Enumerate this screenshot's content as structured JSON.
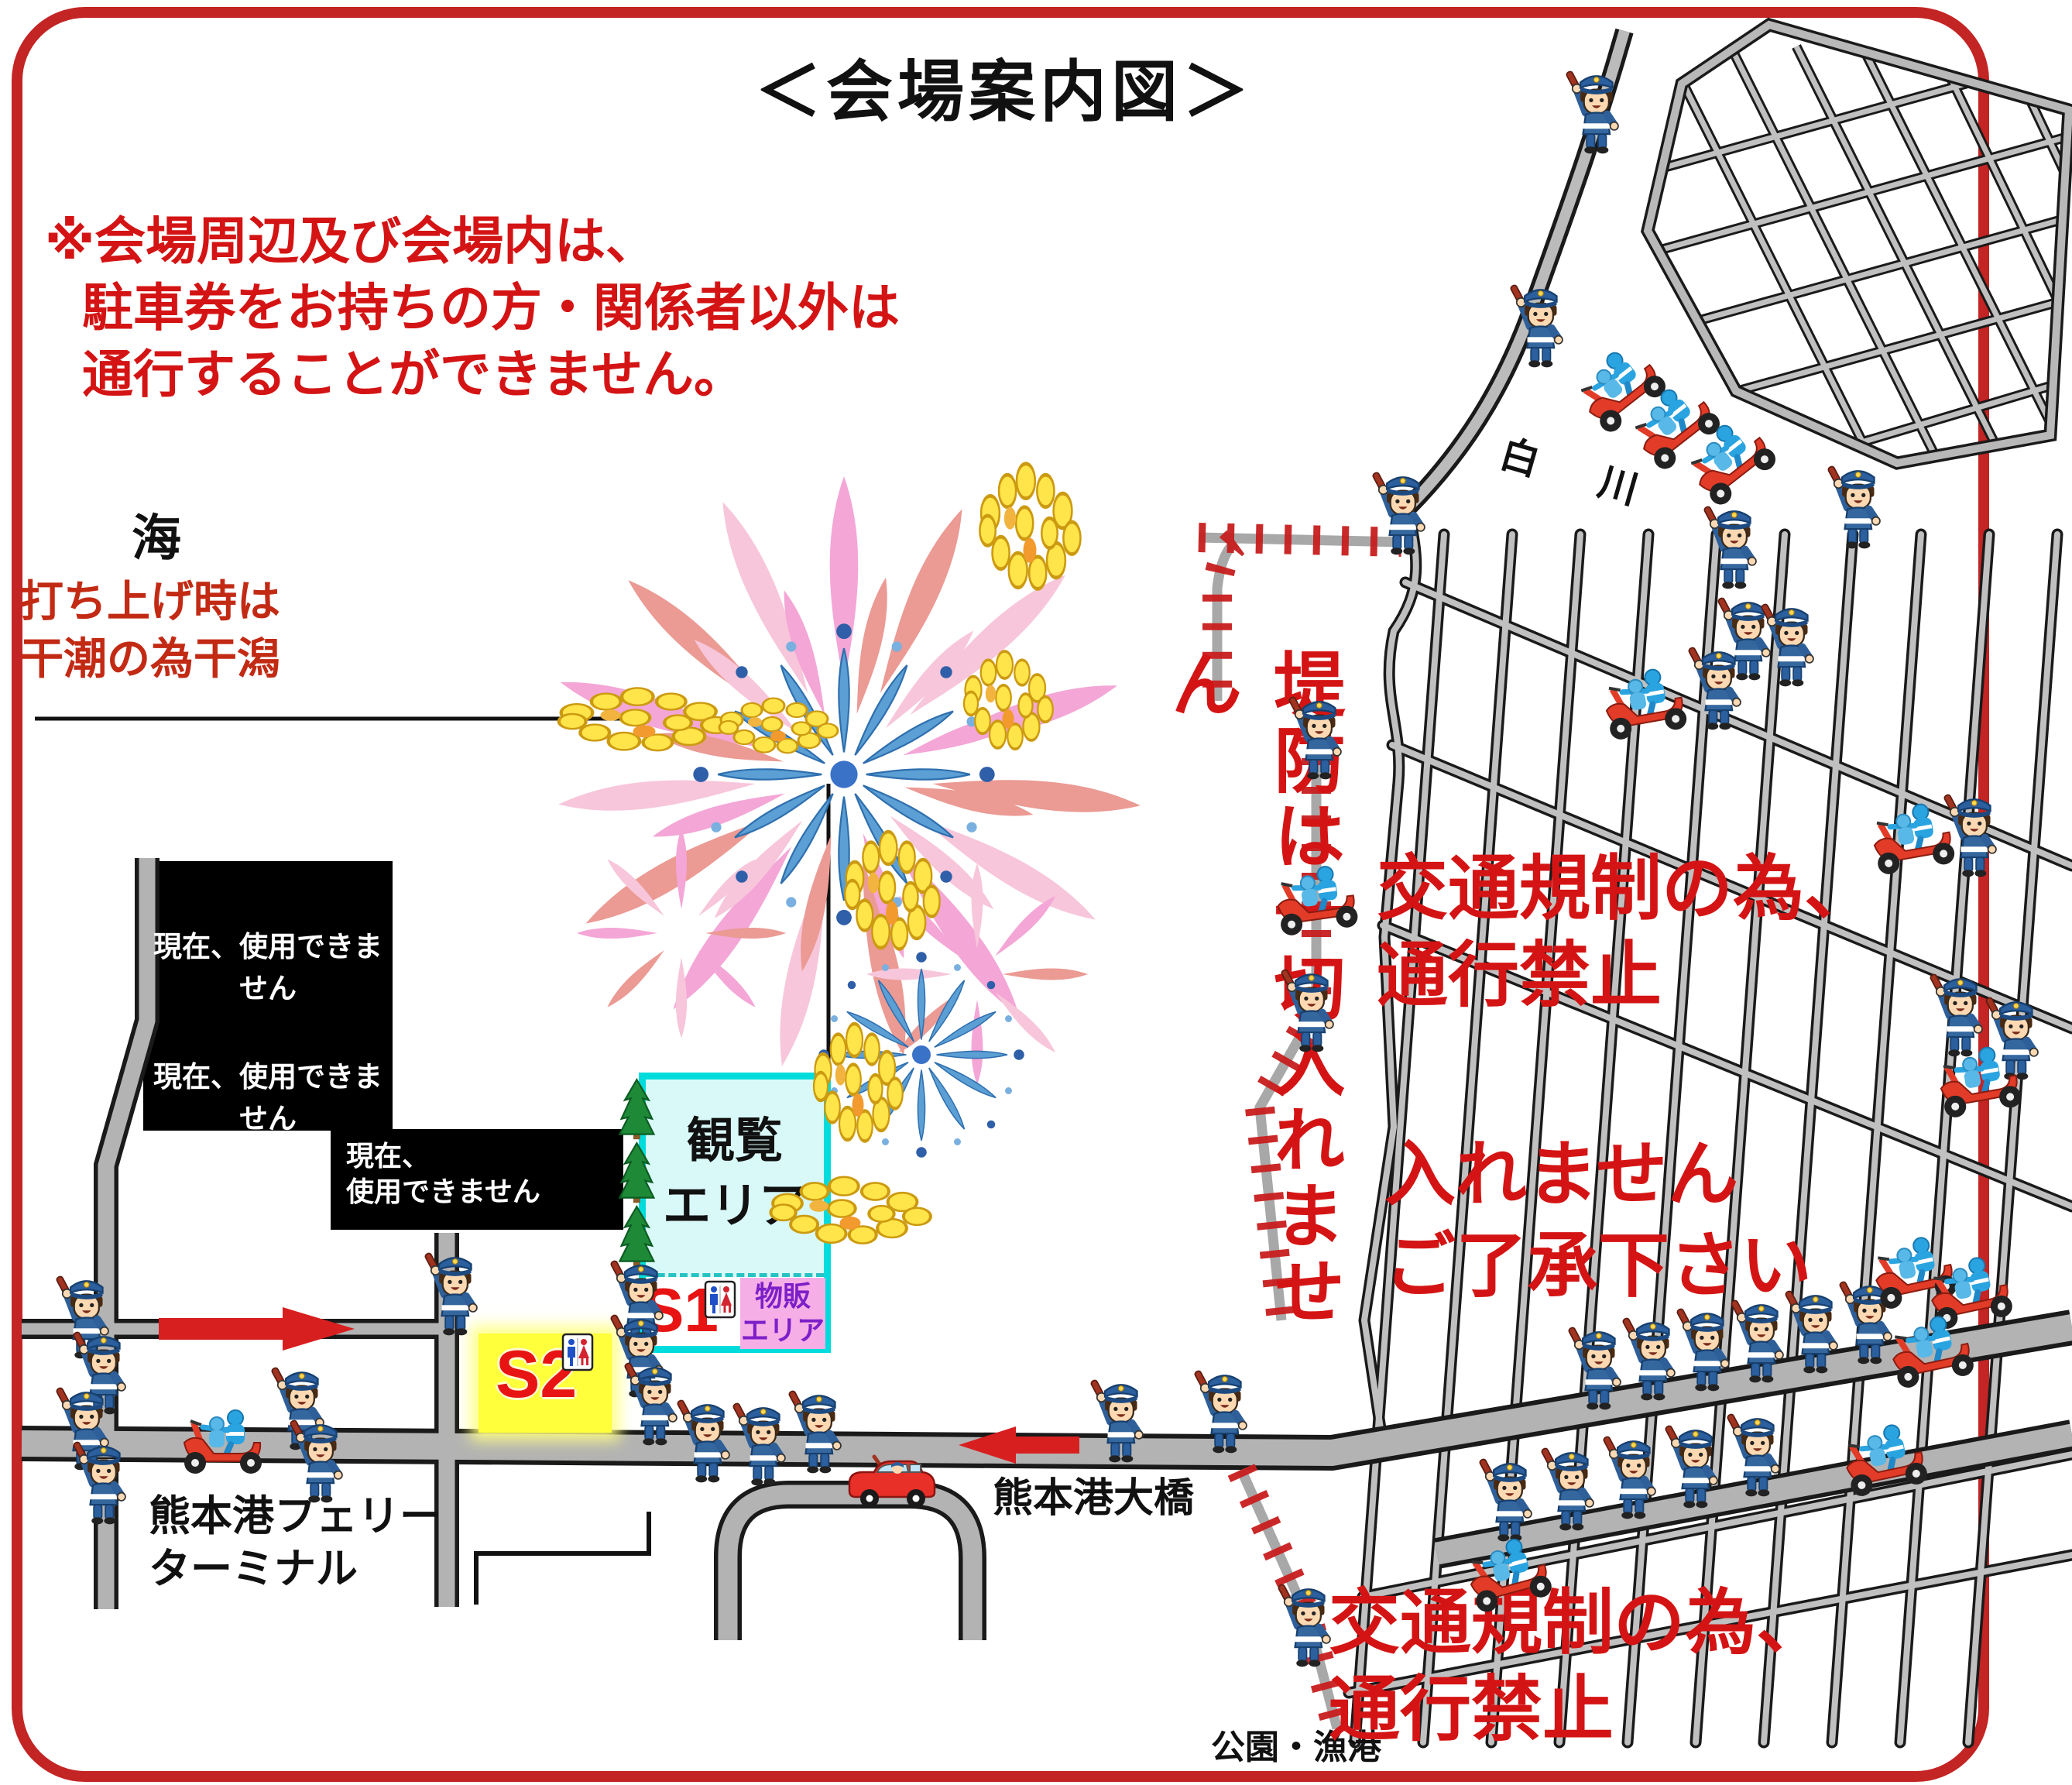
{
  "title": "＜会場案内図＞",
  "notice": {
    "line1": "※会場周辺及び会場内は、",
    "line2": "駐車券をお持ちの方・関係者以外は",
    "line3": "通行することができません。"
  },
  "sea": {
    "label": "海",
    "note_line1": "打ち上げ時は",
    "note_line2": "干潮の為干潟"
  },
  "closed_areas": {
    "label1": "現在、使用できません",
    "label2": "現在、使用できません",
    "label3_line1": "現在、",
    "label3_line2": "使用できません"
  },
  "venue": {
    "viewing_line1": "観覧",
    "viewing_line2": "エリア",
    "s1": "S1",
    "s2": "S2",
    "goods_line1": "物販",
    "goods_line2": "エリア"
  },
  "labels": {
    "river": "白 川",
    "bridge": "熊本港大橋",
    "ferry_line1": "熊本港フェリー",
    "ferry_line2": "ターミナル",
    "park": "公園・漁港",
    "embankment": "堤防は一切入れません",
    "restriction1_line1": "交通規制の為、",
    "restriction1_line2": "通行禁止",
    "notice2_line1": "入れません",
    "notice2_line2": "ご了承下さい",
    "restriction2_line1": "交通規制の為、",
    "restriction2_line2": "通行禁止"
  },
  "colors": {
    "frame_red": "#c32424",
    "warning_red": "#d41414",
    "road_gray": "#b3b3b3",
    "road_outline": "#1a1a1a",
    "closed_black": "#000000",
    "viewing_cyan": "#00dcdc",
    "s2_yellow": "#ffff3c",
    "goods_pink": "#f6aee6",
    "goods_text_purple": "#7d1fc8",
    "officer_blue": "#35679f",
    "scooter_red": "#e23c28",
    "firework_pink": "#f4a6d6",
    "firework_salmon": "#eb9a94",
    "firework_yellow": "#ffe44a"
  },
  "markers": {
    "officers": [
      [
        112,
        1752
      ],
      [
        134,
        1824
      ],
      [
        112,
        1896
      ],
      [
        134,
        1966
      ],
      [
        588,
        1722
      ],
      [
        390,
        1870
      ],
      [
        414,
        1938
      ],
      [
        828,
        1732
      ],
      [
        828,
        1802
      ],
      [
        846,
        1864
      ],
      [
        914,
        1912
      ],
      [
        986,
        1916
      ],
      [
        1058,
        1900
      ],
      [
        1448,
        1886
      ],
      [
        1582,
        1874
      ],
      [
        2062,
        196
      ],
      [
        1990,
        472
      ],
      [
        1812,
        714
      ],
      [
        2240,
        758
      ],
      [
        2258,
        876
      ],
      [
        2314,
        884
      ],
      [
        2220,
        940
      ],
      [
        2400,
        706
      ],
      [
        1704,
        1004
      ],
      [
        1694,
        1356
      ],
      [
        1690,
        2150
      ],
      [
        2065,
        1818
      ],
      [
        2135,
        1806
      ],
      [
        2205,
        1794
      ],
      [
        2275,
        1783
      ],
      [
        2345,
        1771
      ],
      [
        2415,
        1759
      ],
      [
        1950,
        1988
      ],
      [
        2030,
        1974
      ],
      [
        2110,
        1959
      ],
      [
        2190,
        1945
      ],
      [
        2270,
        1930
      ],
      [
        2532,
        1362
      ],
      [
        2604,
        1392
      ],
      [
        2550,
        1130
      ]
    ],
    "scooters": [
      [
        288,
        1862,
        0
      ],
      [
        1700,
        1162,
        -8
      ],
      [
        2124,
        908,
        -10
      ],
      [
        2092,
        500,
        -38
      ],
      [
        2162,
        548,
        -38
      ],
      [
        2234,
        594,
        -38
      ],
      [
        2470,
        1082,
        -10
      ],
      [
        2556,
        1396,
        -10
      ],
      [
        2472,
        1642,
        -12
      ],
      [
        2544,
        1668,
        -12
      ],
      [
        2494,
        1744,
        -12
      ],
      [
        2434,
        1884,
        -12
      ],
      [
        1948,
        2032,
        -15
      ]
    ],
    "cars": [
      [
        1152,
        1912
      ]
    ],
    "toilets": [
      [
        910,
        1654
      ],
      [
        726,
        1722
      ]
    ]
  }
}
